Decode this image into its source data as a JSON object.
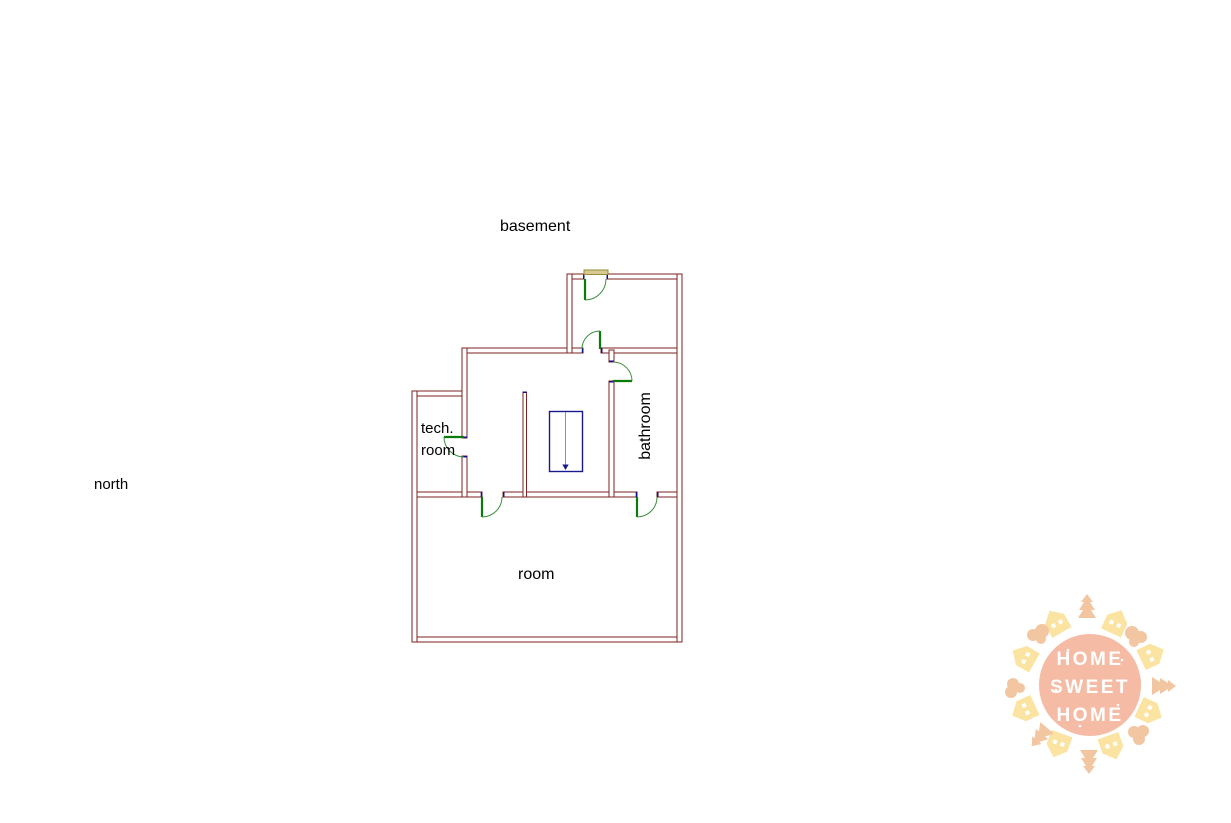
{
  "floorplan": {
    "title": "basement",
    "compass": "north",
    "rooms": {
      "tech_room": {
        "label_line1": "tech.",
        "label_line2": "room"
      },
      "bathroom": {
        "label": "bathroom"
      },
      "room": {
        "label": "room"
      }
    },
    "colors": {
      "wall": "#7e2222",
      "door_leaf": "#0a7a0a",
      "door_arc": "#3d8f3d",
      "jamb_cap": "#10108c",
      "stairs_outline": "#1a1a8c",
      "stairs_center_line": "#909090",
      "threshold_fill": "#d9c88f",
      "threshold_border": "#8f8f3a",
      "label_text": "#000000"
    }
  },
  "logo": {
    "lines": [
      "HOME",
      "SWEET",
      "HOME"
    ],
    "colors": {
      "disc": "#f5bba4",
      "houses": "#fbe3a1",
      "trees": "#f3c6a2",
      "text": "#ffffff"
    }
  }
}
